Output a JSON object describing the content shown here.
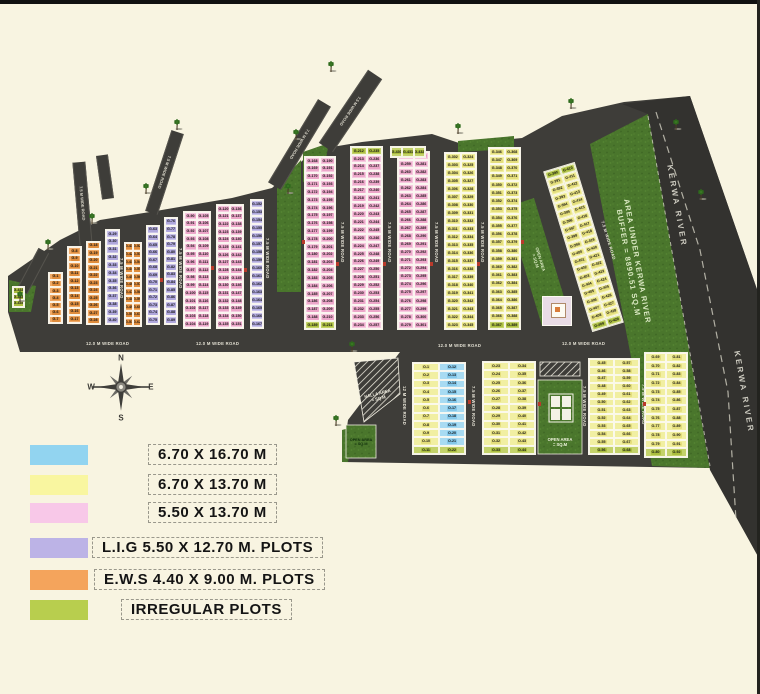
{
  "map": {
    "river_label": "KERWA RIVER",
    "buffer_label_line1": "AREA UNDER KERWA RIVER",
    "buffer_label_line2": "BUFFER = 8890.51 SQ.M",
    "nalla_label_line1": "NALLA AREA",
    "nalla_label_line2": "= SQ.M",
    "open_area_label_line1": "OPEN AREA",
    "open_area_label_line2": "= SQ.M",
    "road_labels": [
      {
        "x": 86,
        "y": 341,
        "o": "h",
        "text": "12.0 M WIDE ROAD"
      },
      {
        "x": 196,
        "y": 341,
        "o": "h",
        "text": "12.0 M WIDE ROAD"
      },
      {
        "x": 438,
        "y": 343,
        "o": "h",
        "text": "12.0 M WIDE ROAD"
      },
      {
        "x": 562,
        "y": 341,
        "o": "h",
        "text": "12.0 M WIDE ROAD"
      },
      {
        "x": 119,
        "y": 258,
        "o": "v",
        "text": "7.5 M WIDE ROAD"
      },
      {
        "x": 178,
        "y": 248,
        "o": "v",
        "text": "7.5 M WIDE ROAD"
      },
      {
        "x": 265,
        "y": 238,
        "o": "v",
        "text": "7.5 M WIDE ROAD"
      },
      {
        "x": 340,
        "y": 222,
        "o": "v",
        "text": "7.5 M WIDE ROAD"
      },
      {
        "x": 387,
        "y": 222,
        "o": "v",
        "text": "7.5 M WIDE ROAD"
      },
      {
        "x": 434,
        "y": 222,
        "o": "v",
        "text": "7.5 M WIDE ROAD"
      },
      {
        "x": 480,
        "y": 222,
        "o": "v",
        "text": "7.5 M WIDE ROAD"
      },
      {
        "x": 606,
        "y": 220,
        "o": "d",
        "rot": -17,
        "text": "7.5 M WIDE ROAD"
      },
      {
        "x": 402,
        "y": 386,
        "o": "v",
        "text": "12 M WIDE ROAD"
      },
      {
        "x": 471,
        "y": 386,
        "o": "v",
        "text": "7.5 M WIDE ROAD"
      },
      {
        "x": 582,
        "y": 386,
        "o": "v",
        "text": "7.5 M WIDE ROAD"
      },
      {
        "x": 641,
        "y": 384,
        "o": "v",
        "text": "7.5 M WIDE ROAD"
      }
    ],
    "stub_roads": [
      {
        "cx": 32,
        "cy": 271,
        "w": 10,
        "h": 46,
        "rot": 28,
        "text": ""
      },
      {
        "cx": 81,
        "cy": 203,
        "w": 11,
        "h": 83,
        "rot": -5,
        "text": "7.5 M WIDE ROAD"
      },
      {
        "cx": 104,
        "cy": 177,
        "w": 10,
        "h": 44,
        "rot": -8,
        "text": ""
      },
      {
        "cx": 163,
        "cy": 172,
        "w": 11,
        "h": 85,
        "rot": 18,
        "text": "7.5 M WIDE ROAD"
      },
      {
        "cx": 298,
        "cy": 144,
        "w": 13,
        "h": 97,
        "rot": 31,
        "text": "7.5 M WIDE ROAD"
      },
      {
        "cx": 349,
        "cy": 111,
        "w": 15,
        "h": 88,
        "rot": 34,
        "text": "7.5 M WIDE ROAD"
      }
    ],
    "blocks": [
      {
        "x": 48,
        "y": 272,
        "w": 15,
        "h": 52,
        "rows": 7,
        "cols": 1,
        "type": "orange",
        "prefix": "G-",
        "start": 1
      },
      {
        "x": 67,
        "y": 246,
        "w": 15,
        "h": 78,
        "rows": 10,
        "cols": 1,
        "type": "orange",
        "prefix": "G-",
        "start": 8
      },
      {
        "x": 86,
        "y": 241,
        "w": 15,
        "h": 84,
        "rows": 11,
        "cols": 1,
        "type": "orange",
        "prefix": "G-",
        "start": 18
      },
      {
        "x": 105,
        "y": 229,
        "w": 15,
        "h": 96,
        "rows": 12,
        "cols": 1,
        "type": "purple",
        "prefix": "G-",
        "start": 29
      },
      {
        "x": 124,
        "y": 242,
        "w": 18,
        "h": 85,
        "rows": 11,
        "cols": 2,
        "type": "orange",
        "prefix": "G-",
        "start": 41
      },
      {
        "x": 146,
        "y": 225,
        "w": 14,
        "h": 100,
        "rows": 13,
        "cols": 1,
        "type": "purple",
        "prefix": "G-",
        "start": 63
      },
      {
        "x": 164,
        "y": 217,
        "w": 14,
        "h": 108,
        "rows": 14,
        "cols": 1,
        "type": "purple",
        "prefix": "G-",
        "start": 76
      },
      {
        "x": 183,
        "y": 211,
        "w": 28,
        "h": 118,
        "rows": 15,
        "cols": 2,
        "type": "pink",
        "prefix": "G-",
        "start": 90
      },
      {
        "x": 216,
        "y": 204,
        "w": 28,
        "h": 125,
        "rows": 16,
        "cols": 2,
        "type": "pink",
        "prefix": "G-",
        "start": 120
      },
      {
        "x": 250,
        "y": 199,
        "w": 14,
        "h": 130,
        "rows": 16,
        "cols": 1,
        "type": "purple",
        "prefix": "G-",
        "start": 152
      },
      {
        "x": 304,
        "y": 156,
        "w": 32,
        "h": 174,
        "rows": 22,
        "cols": 2,
        "type": "pink",
        "prefix": "G-",
        "start": 168,
        "lastRowGreen": true
      },
      {
        "x": 350,
        "y": 146,
        "w": 33,
        "h": 184,
        "rows": 23,
        "cols": 2,
        "type": "pink",
        "prefix": "G-",
        "start": 212,
        "firstRowGreen": true
      },
      {
        "x": 397,
        "y": 151,
        "w": 33,
        "h": 179,
        "rows": 22,
        "cols": 2,
        "type": "pink",
        "prefix": "G-",
        "start": 258
      },
      {
        "x": 444,
        "y": 152,
        "w": 33,
        "h": 178,
        "rows": 22,
        "cols": 2,
        "type": "yellow",
        "prefix": "G-",
        "start": 302
      },
      {
        "x": 488,
        "y": 147,
        "w": 33,
        "h": 183,
        "rows": 22,
        "cols": 2,
        "type": "yellow",
        "prefix": "G-",
        "start": 346,
        "lastRowGreen": true
      },
      {
        "x": 567,
        "y": 163,
        "w": 33,
        "h": 168,
        "rows": 20,
        "cols": 2,
        "type": "yellow",
        "prefix": "G-",
        "start": 390,
        "rot": -17,
        "firstRowGreen": true,
        "lastRowGreen": true
      },
      {
        "x": 390,
        "y": 146,
        "w": 36,
        "h": 12,
        "rows": 1,
        "cols": 3,
        "type": "green",
        "prefix": "G-",
        "start": 430
      },
      {
        "x": 12,
        "y": 286,
        "w": 13,
        "h": 22,
        "rows": 3,
        "cols": 1,
        "type": "green",
        "prefix": "G-",
        "start": 433
      },
      {
        "x": 412,
        "y": 362,
        "w": 54,
        "h": 93,
        "rows": 11,
        "cols": 2,
        "colTypes": [
          "yellow",
          "blue"
        ],
        "prefix": "O-",
        "start": 1,
        "lastRowGreen": true
      },
      {
        "x": 482,
        "y": 361,
        "w": 54,
        "h": 94,
        "rows": 11,
        "cols": 2,
        "type": "yellow",
        "prefix": "O-",
        "start": 23,
        "lastRowGreen": true
      },
      {
        "x": 588,
        "y": 358,
        "w": 52,
        "h": 97,
        "rows": 12,
        "cols": 2,
        "type": "yellow",
        "prefix": "O-",
        "start": 45,
        "lastRowGreen": true
      },
      {
        "x": 644,
        "y": 352,
        "w": 44,
        "h": 106,
        "rows": 12,
        "cols": 2,
        "type": "yellow",
        "prefix": "O-",
        "start": 69,
        "lastRowGreen": true
      }
    ]
  },
  "plot_colors": {
    "pink": {
      "fill": "#F5CADF",
      "pill": "#ECA6C9"
    },
    "yellow": {
      "fill": "#F1EFA2",
      "pill": "#E4DE7C"
    },
    "blue": {
      "fill": "#A8DBF2",
      "pill": "#83C7E9"
    },
    "purple": {
      "fill": "#C9C3E9",
      "pill": "#AFA7DC"
    },
    "orange": {
      "fill": "#EFA966",
      "pill": "#DF8C3C"
    },
    "green": {
      "fill": "#C3D26A",
      "pill": "#ABBE3F"
    }
  },
  "colors": {
    "background": "#F8F4E1",
    "road": "#3E3D39",
    "river": "#33322F",
    "grass": "#4A762C",
    "grass_light": "#578833",
    "hatch_line": "#E8E5D8",
    "legend_blue": "#92D4F0",
    "legend_yellow": "#F9F6A0",
    "legend_pink": "#F8C8E8",
    "legend_purple": "#BCB3E6",
    "legend_orange": "#F4A45C",
    "legend_green": "#B8CE4E"
  },
  "legend": {
    "items": [
      {
        "color": "legend_blue",
        "label": "6.70 X 16.70 M"
      },
      {
        "color": "legend_yellow",
        "label": "6.70 X 13.70 M"
      },
      {
        "color": "legend_pink",
        "label": "5.50 X 13.70 M"
      },
      {
        "color": "legend_purple",
        "label": "L.I.G  5.50 X 12.70 M. PLOTS"
      },
      {
        "color": "legend_orange",
        "label": "E.W.S 4.40 X 9.00 M. PLOTS"
      },
      {
        "color": "legend_green",
        "label": "IRREGULAR PLOTS"
      }
    ]
  },
  "compass": {
    "n": "N",
    "e": "E",
    "s": "S",
    "w": "W"
  }
}
